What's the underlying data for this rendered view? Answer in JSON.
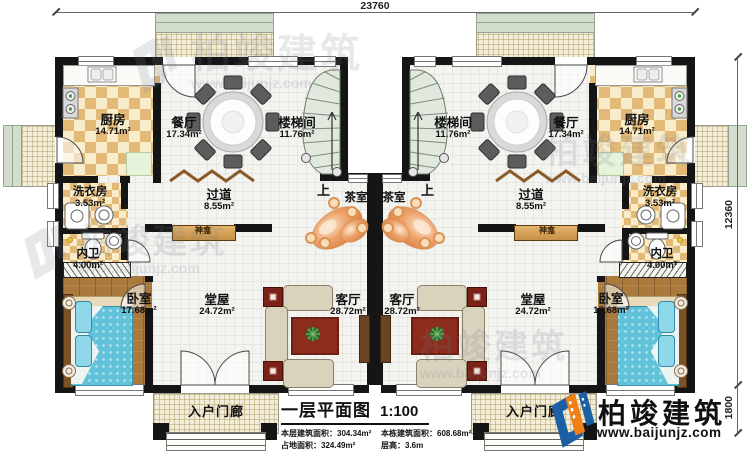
{
  "plan": {
    "dim_top": "23760",
    "dim_right_main": "12360",
    "dim_right_porch": "1800",
    "up_label": "上"
  },
  "rooms": {
    "kitchen": {
      "name": "厨房",
      "area": "14.71m²"
    },
    "dining": {
      "name": "餐厅",
      "area": "17.34m²"
    },
    "stairwell": {
      "name": "楼梯间",
      "area": "11.76m²"
    },
    "laundry": {
      "name": "洗衣房",
      "area": "3.53m²"
    },
    "corridor": {
      "name": "过道",
      "area": "8.55m²"
    },
    "tea_room": {
      "name": "茶室"
    },
    "bathroom": {
      "name": "内卫",
      "area": "4.00m²"
    },
    "bedroom": {
      "name": "卧室",
      "area": "17.68m²"
    },
    "hall": {
      "name": "堂屋",
      "area": "24.72m²"
    },
    "living_room": {
      "name": "客厅",
      "area": "28.72m²"
    },
    "shrine": {
      "name": "神龛"
    },
    "entry_porch": {
      "name": "入户门廊"
    }
  },
  "title_block": {
    "title": "一层平面图",
    "scale": "1:100",
    "stats": [
      {
        "label": "本层建筑面积：",
        "value": "304.34m²"
      },
      {
        "label": "本栋建筑面积：",
        "value": "608.68m²"
      },
      {
        "label": "占地面积：",
        "value": "324.49m²"
      },
      {
        "label": "层高：",
        "value": "3.6m"
      }
    ]
  },
  "logo": {
    "brand": "柏竣建筑",
    "website": "www.baijunjz.com"
  },
  "watermark": {
    "brand": "柏竣建筑",
    "website": "www.baijunjz.com"
  },
  "colors": {
    "wall": "#151515",
    "checker": "#e2b977",
    "wood": "#a97a3c",
    "bed": "#62c2da",
    "tea_stone": "#e08a4e",
    "logo_blue": "#1c5fa5",
    "logo_orange": "#ef8018"
  }
}
